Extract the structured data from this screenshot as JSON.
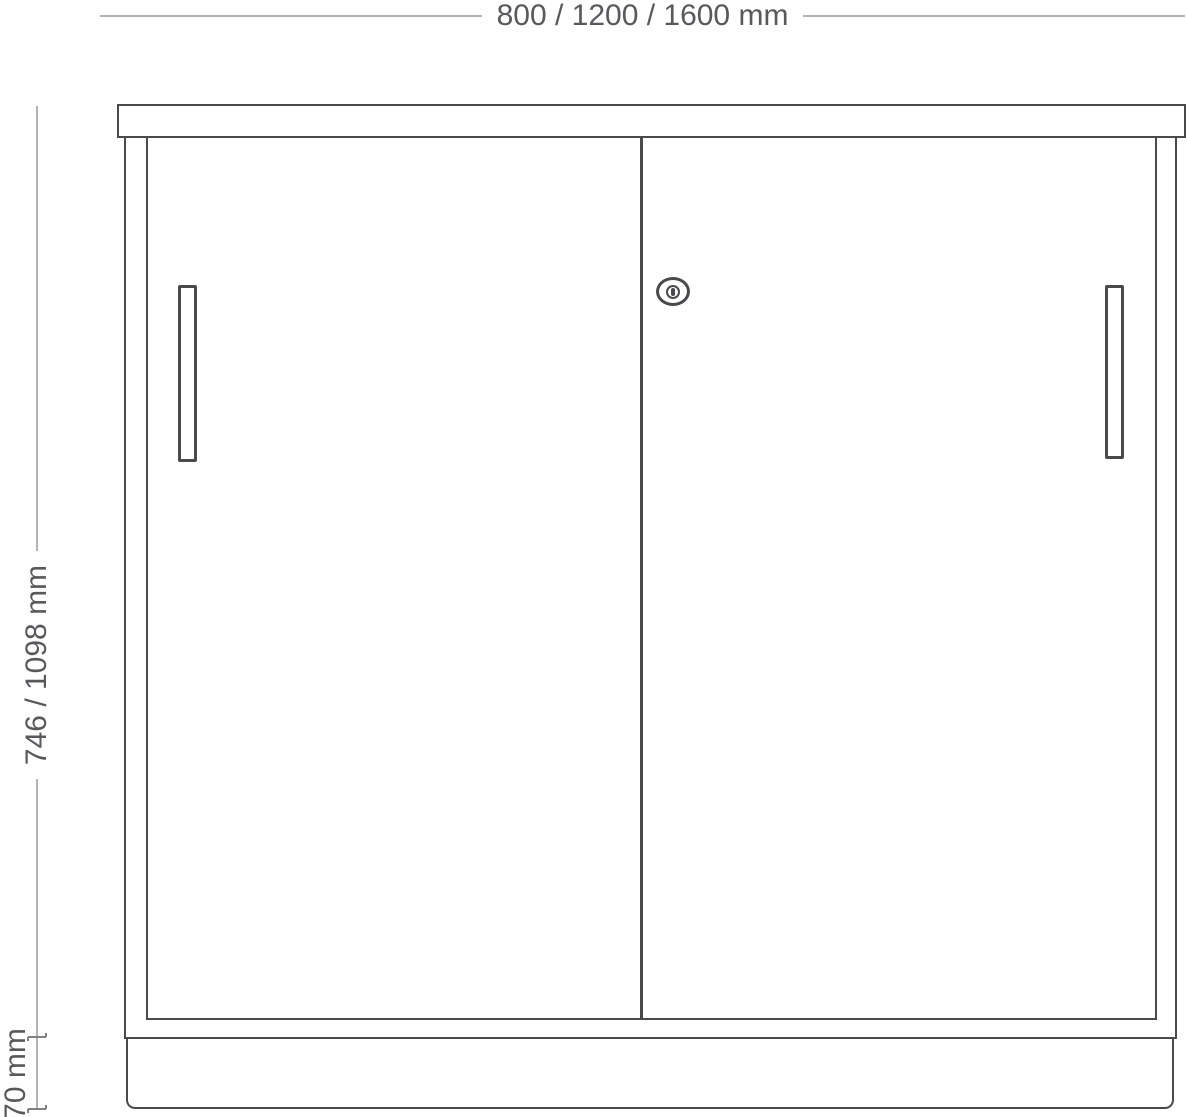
{
  "drawing": {
    "width_dimension": {
      "label": "800 / 1200 / 1600 mm"
    },
    "height_dimension": {
      "label": "746 / 1098 mm"
    },
    "plinth_dimension": {
      "label": "70 mm"
    }
  },
  "icons": {
    "lock": "oval-keyhole-lock-glyph"
  },
  "colors": {
    "outline": "#4a4a4c",
    "dimension_line": "#b2b2b3",
    "tick": "#808083",
    "label_text": "#59595b",
    "background": "#ffffff"
  }
}
